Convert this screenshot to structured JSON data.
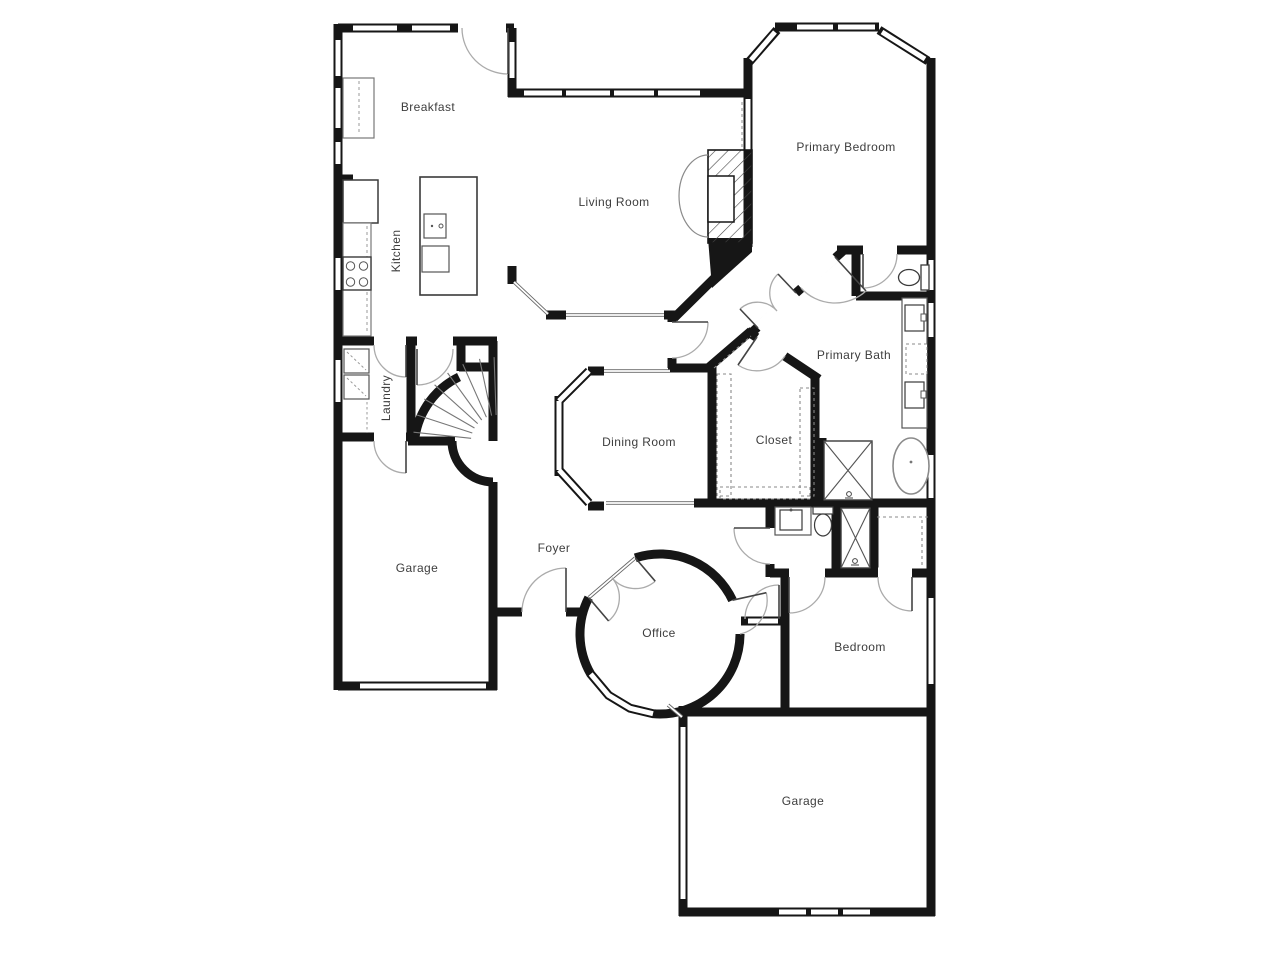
{
  "floor_plan": {
    "type": "residential-floor-plan",
    "colors": {
      "wall": "#161616",
      "fixture_line": "#555555",
      "door_arc": "#aaaaaa",
      "label_text": "#3d3d3d",
      "background": "#ffffff"
    },
    "rooms": [
      {
        "id": "breakfast",
        "label": "Breakfast"
      },
      {
        "id": "kitchen",
        "label": "Kitchen"
      },
      {
        "id": "living-room",
        "label": "Living Room"
      },
      {
        "id": "primary-bedroom",
        "label": "Primary Bedroom"
      },
      {
        "id": "primary-bath",
        "label": "Primary Bath"
      },
      {
        "id": "laundry",
        "label": "Laundry"
      },
      {
        "id": "dining-room",
        "label": "Dining Room"
      },
      {
        "id": "closet",
        "label": "Closet"
      },
      {
        "id": "garage-left",
        "label": "Garage"
      },
      {
        "id": "foyer",
        "label": "Foyer"
      },
      {
        "id": "office",
        "label": "Office"
      },
      {
        "id": "bedroom",
        "label": "Bedroom"
      },
      {
        "id": "garage-bottom",
        "label": "Garage"
      }
    ]
  }
}
